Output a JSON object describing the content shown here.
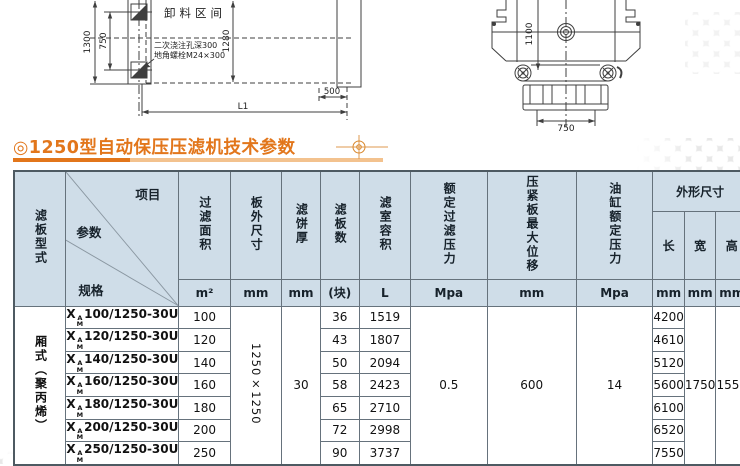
{
  "title": {
    "text": "◎1250型自动保压压滤机技术参数"
  },
  "colors": {
    "accent": "#e2761b",
    "accent_light": "#f3c28e",
    "header_bg": "#cfdde8"
  },
  "drawings": {
    "plan": {
      "discharge_label": "卸料区间",
      "note_line1": "二次浇注孔深300",
      "note_line2": "地角螺栓M24×300",
      "dim_total_height": "1300",
      "dim_bolt_spacing": "750",
      "dim_inner_height": "1280",
      "dim_offset": "500",
      "dim_length": "L1"
    },
    "front": {
      "dim_height": "1100",
      "dim_base_width": "750"
    }
  },
  "table": {
    "header": {
      "plate_type_label": "滤板型式",
      "diagonal": {
        "item": "项目",
        "param": "参数",
        "spec": "规格"
      },
      "columns": [
        {
          "label": "过滤面积",
          "unit": "m²"
        },
        {
          "label": "板外尺寸",
          "unit": "mm"
        },
        {
          "label": "滤饼厚",
          "unit": "mm"
        },
        {
          "label": "滤板数",
          "unit": "(块)"
        },
        {
          "label": "滤室容积",
          "unit": "L"
        },
        {
          "label": "额定过滤压力",
          "unit": "Mpa"
        },
        {
          "label": "压紧板最大位移",
          "unit": "mm"
        },
        {
          "label": "油缸额定压力",
          "unit": "Mpa"
        }
      ],
      "overall": {
        "label": "外形尺寸",
        "sub0": "长",
        "sub1": "宽",
        "sub2": "高",
        "u0": "mm",
        "u1": "mm",
        "u2": "mm"
      },
      "weight": {
        "label": "整机质量",
        "unit": "Kg"
      },
      "foundation": {
        "label": "地基尺寸",
        "sub0": "L1",
        "sub1": "b",
        "sub2": "c",
        "u0": "mm",
        "u1": "mm",
        "u2": "mm"
      }
    },
    "body": {
      "plate_type": "厢式（聚丙烯）",
      "merged": {
        "plate_size": "1250×1250",
        "cake_thickness": "30",
        "filter_pressure": "0.5",
        "max_displacement": "600",
        "cylinder_pressure": "14",
        "width": "1750",
        "height": "1550",
        "b": "750",
        "c": "1250"
      },
      "rows": [
        {
          "prefix": "X",
          "sup": "A",
          "sub": "M",
          "spec": "100/1250-30U",
          "area": "100",
          "plates": "36",
          "volume": "1519",
          "length": "4200",
          "weight": "4960",
          "l1": "3260"
        },
        {
          "prefix": "X",
          "sup": "A",
          "sub": "M",
          "spec": "120/1250-30U",
          "area": "120",
          "plates": "43",
          "volume": "1807",
          "length": "4610",
          "weight": "5420",
          "l1": "3670"
        },
        {
          "prefix": "X",
          "sup": "A",
          "sub": "M",
          "spec": "140/1250-30U",
          "area": "140",
          "plates": "50",
          "volume": "2094",
          "length": "5120",
          "weight": "5890",
          "l1": "4130"
        },
        {
          "prefix": "X",
          "sup": "A",
          "sub": "M",
          "spec": "160/1250-30U",
          "area": "160",
          "plates": "58",
          "volume": "2423",
          "length": "5600",
          "weight": "6410",
          "l1": "4610"
        },
        {
          "prefix": "X",
          "sup": "A",
          "sub": "M",
          "spec": "180/1250-30U",
          "area": "180",
          "plates": "65",
          "volume": "2710",
          "length": "6100",
          "weight": "6870",
          "l1": "5070"
        },
        {
          "prefix": "X",
          "sup": "A",
          "sub": "M",
          "spec": "200/1250-30U",
          "area": "200",
          "plates": "72",
          "volume": "2998",
          "length": "6520",
          "weight": "7330",
          "l1": "5480"
        },
        {
          "prefix": "X",
          "sup": "A",
          "sub": "M",
          "spec": "250/1250-30U",
          "area": "250",
          "plates": "90",
          "volume": "3737",
          "length": "7550",
          "weight": "8480",
          "l1": "6510"
        }
      ]
    }
  }
}
